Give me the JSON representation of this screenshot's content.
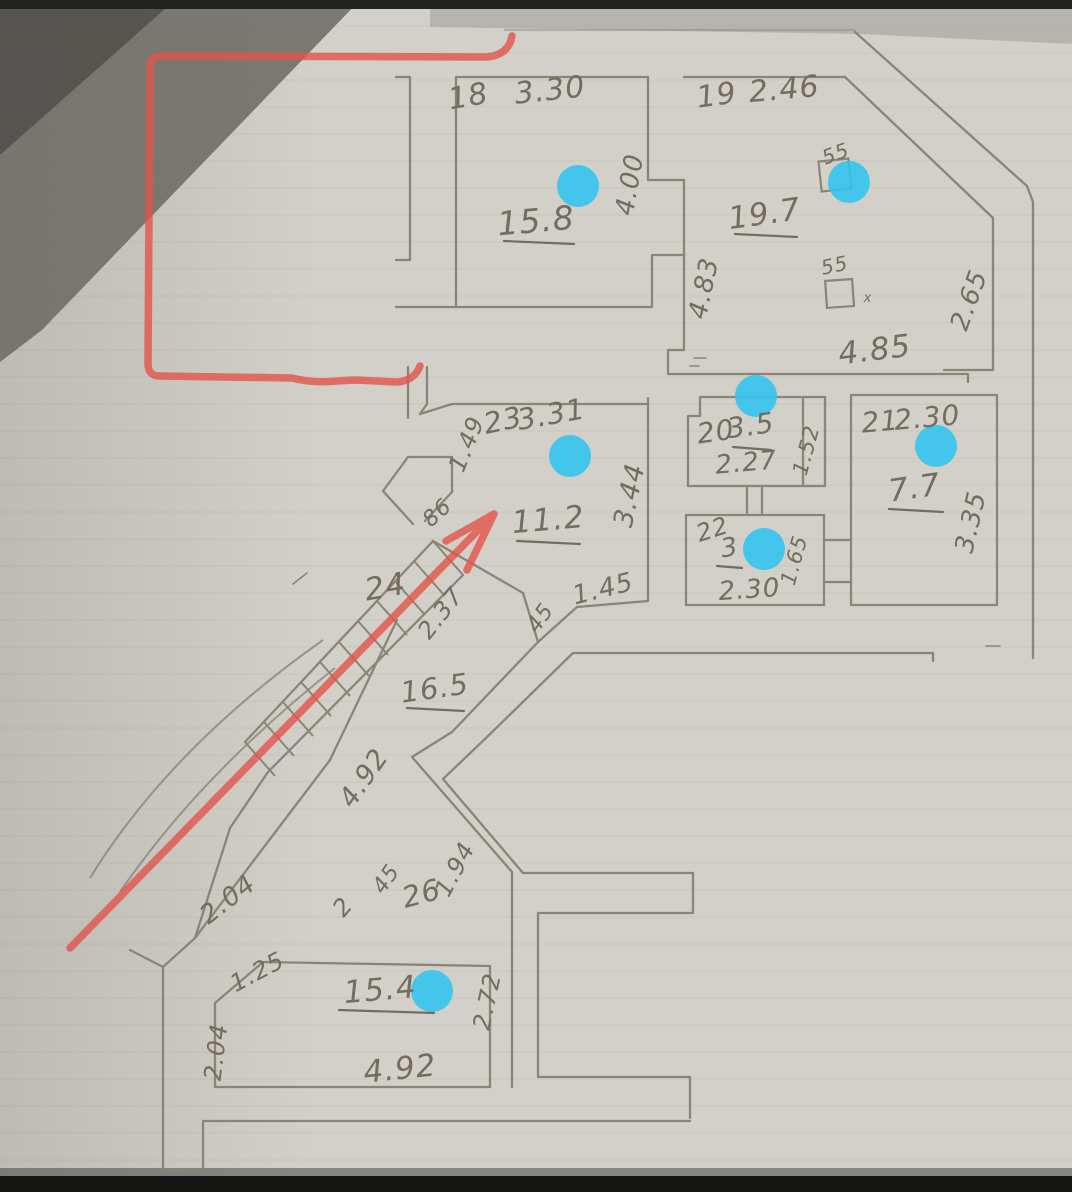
{
  "title": "Hand-drawn floor plan sketch (photo)",
  "colors": {
    "paper": "#d2d0c8",
    "ruled_line": "#bdbbb2",
    "pencil": "#8b8578",
    "ink": "#746d5f",
    "red": "#e4544a",
    "cyan": "#30c4f0",
    "shadow": "#6b6962",
    "shadow_dark": "#53514c",
    "band_black": "#161614"
  },
  "markers": {
    "type": "cyan-dot",
    "count": 7,
    "color": "#30c4f0"
  },
  "rooms": {
    "r18": {
      "number": "18",
      "width": "3.30",
      "height": "4.00",
      "area": "15.8"
    },
    "r19": {
      "number": "19",
      "width": "2.46",
      "area": "19.7",
      "dim_left": "4.83",
      "dim_diag": "2.65",
      "dim_bottom": "4.85",
      "square1": "55",
      "square2": "55",
      "tick": "x"
    },
    "hall": {
      "dim_small": "3.4"
    },
    "r20": {
      "number": "20",
      "area": "3.5",
      "width": "2.27",
      "dim_right": "1.52"
    },
    "r21": {
      "number": "21",
      "width": "2.30",
      "area": "7.7",
      "dim_right": "3.35"
    },
    "r22": {
      "number": "22",
      "area": "3",
      "width": "2.30",
      "dim_right": "1.65"
    },
    "r23": {
      "number": "23",
      "width": "3.31",
      "dim_left": "1.49",
      "area": "11.2",
      "dim_right": "3.44",
      "dim_bottom": "1.45",
      "door": "45",
      "door_wall": "86"
    },
    "stairs": {
      "number": "24",
      "dim_diag": "2.37",
      "area": "16.5"
    },
    "corridor": {
      "dim_a": "4.92",
      "dim_b": "1.94",
      "dim_c": "2.04",
      "dim_d": "2",
      "door": "45",
      "number": "26"
    },
    "r15": {
      "area": "15.4",
      "dim_top": "1.25",
      "dim_right": "2.72",
      "dim_left": "2.04",
      "dim_bottom": "4.92"
    }
  }
}
